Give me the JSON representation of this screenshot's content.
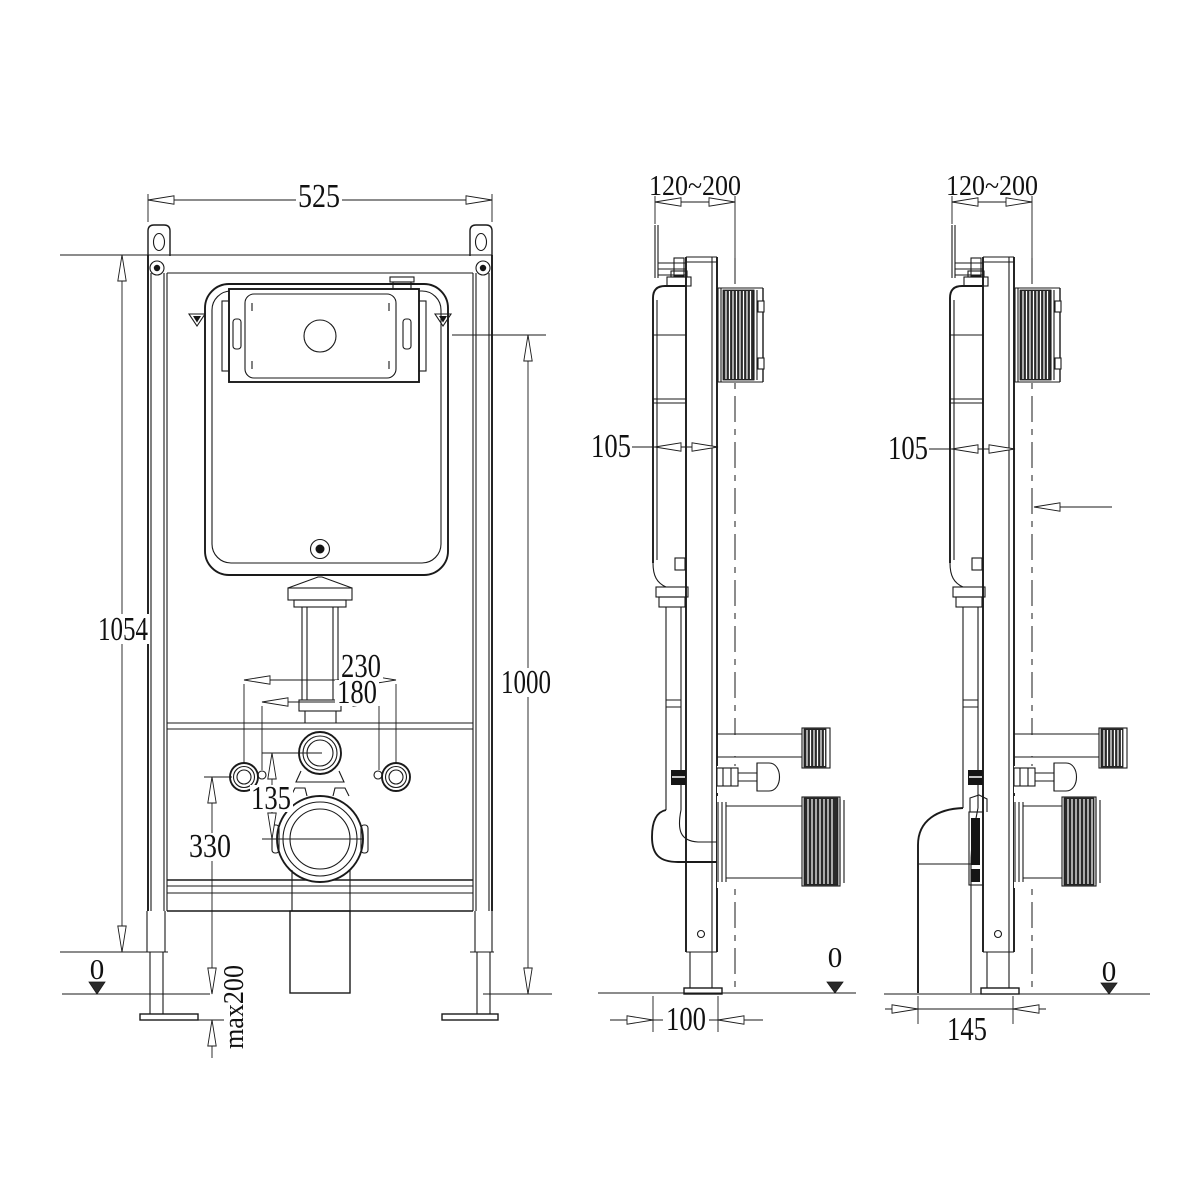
{
  "front": {
    "width": "525",
    "frame_height": "1054",
    "flush_plate_height": "1000",
    "fixing_spacing_outer": "230",
    "fixing_spacing_inner": "180",
    "supply_to_outlet_offset": "135",
    "outlet_center_height": "330",
    "floor_datum": "0",
    "foot_adjustment": "max200"
  },
  "side_a": {
    "wall_depth_range": "120~200",
    "frame_depth": "105",
    "floor_depth": "100",
    "floor_datum": "0"
  },
  "side_b": {
    "wall_depth_range": "120~200",
    "frame_depth": "105",
    "floor_depth": "145",
    "floor_datum": "0"
  },
  "style": {
    "line_color": "#1a1a1a",
    "background": "#ffffff"
  }
}
